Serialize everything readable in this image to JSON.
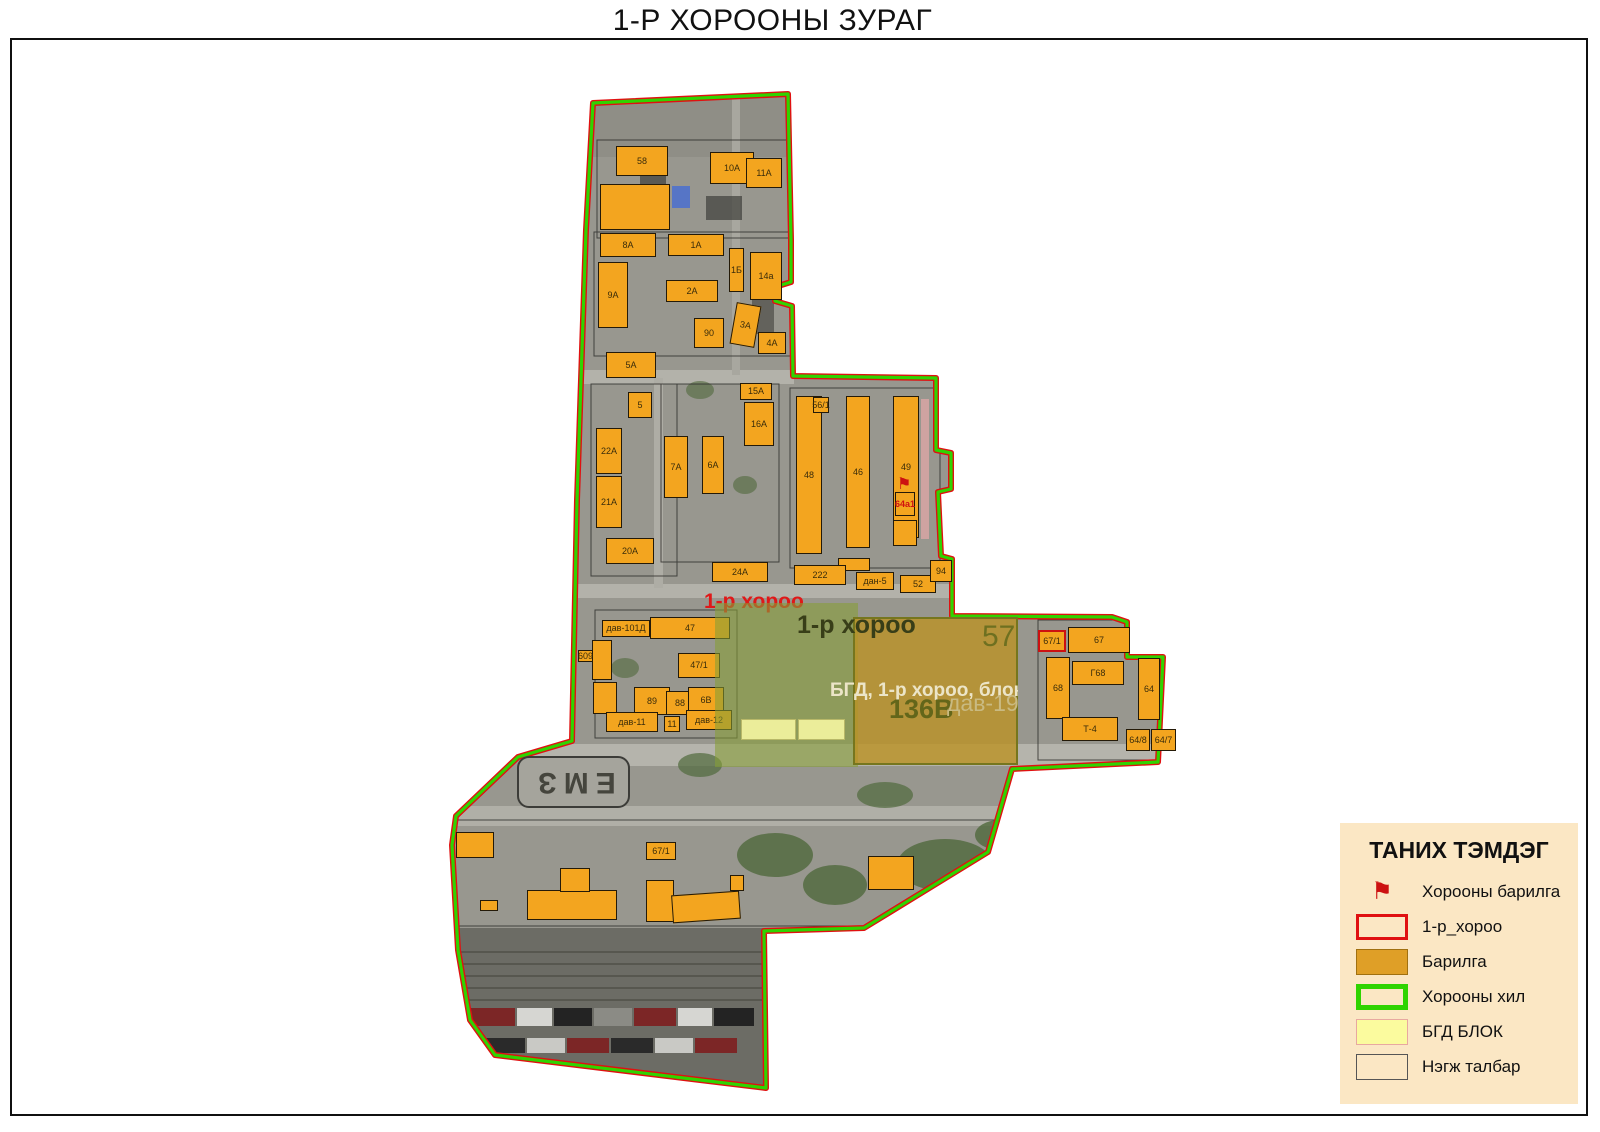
{
  "title": "1-Р ХОРООНЫ ЗУРАГ",
  "legend": {
    "title": "ТАНИХ ТЭМДЭГ",
    "items": [
      {
        "type": "flag",
        "label": "Хорооны барилга"
      },
      {
        "type": "red-outline",
        "label": "1-р_хороо"
      },
      {
        "type": "orange-fill",
        "label": "Барилга"
      },
      {
        "type": "green-outline",
        "label": "Хорооны хил"
      },
      {
        "type": "yellow-fill",
        "label": "БГД БЛОК"
      },
      {
        "type": "beige-fill",
        "label": "Нэгж талбар"
      }
    ]
  },
  "map": {
    "red_area_label": "1-р хороо",
    "overlay_area_label": "1-р хороо",
    "parcel_number": "57",
    "block_caption": "БГД, 1-р хороо, блок",
    "parcel_code": "136В",
    "dav_label": "дав-19",
    "ground_marking": "ЕМЗ",
    "buildings": [
      {
        "label": "58",
        "x": 616,
        "y": 146,
        "w": 52,
        "h": 30
      },
      {
        "label": "",
        "x": 600,
        "y": 184,
        "w": 70,
        "h": 46
      },
      {
        "label": "10A",
        "x": 710,
        "y": 152,
        "w": 44,
        "h": 32
      },
      {
        "label": "11A",
        "x": 746,
        "y": 158,
        "w": 36,
        "h": 30
      },
      {
        "label": "8A",
        "x": 600,
        "y": 233,
        "w": 56,
        "h": 24
      },
      {
        "label": "1A",
        "x": 668,
        "y": 234,
        "w": 56,
        "h": 22
      },
      {
        "label": "1Б",
        "x": 729,
        "y": 248,
        "w": 15,
        "h": 44
      },
      {
        "label": "14a",
        "x": 750,
        "y": 252,
        "w": 32,
        "h": 48
      },
      {
        "label": "9A",
        "x": 598,
        "y": 262,
        "w": 30,
        "h": 66
      },
      {
        "label": "2A",
        "x": 666,
        "y": 280,
        "w": 52,
        "h": 22
      },
      {
        "label": "90",
        "x": 694,
        "y": 318,
        "w": 30,
        "h": 30
      },
      {
        "label": "3A",
        "x": 733,
        "y": 304,
        "w": 25,
        "h": 42,
        "rot": 10
      },
      {
        "label": "4A",
        "x": 758,
        "y": 332,
        "w": 28,
        "h": 22
      },
      {
        "label": "5A",
        "x": 606,
        "y": 352,
        "w": 50,
        "h": 26
      },
      {
        "label": "5",
        "x": 628,
        "y": 392,
        "w": 24,
        "h": 26
      },
      {
        "label": "15A",
        "x": 740,
        "y": 383,
        "w": 32,
        "h": 17
      },
      {
        "label": "16A",
        "x": 744,
        "y": 402,
        "w": 30,
        "h": 44
      },
      {
        "label": "22A",
        "x": 596,
        "y": 428,
        "w": 26,
        "h": 46
      },
      {
        "label": "7A",
        "x": 664,
        "y": 436,
        "w": 24,
        "h": 62
      },
      {
        "label": "6A",
        "x": 702,
        "y": 436,
        "w": 22,
        "h": 58
      },
      {
        "label": "21A",
        "x": 596,
        "y": 476,
        "w": 26,
        "h": 52
      },
      {
        "label": "20A",
        "x": 606,
        "y": 538,
        "w": 48,
        "h": 26
      },
      {
        "label": "48",
        "x": 796,
        "y": 396,
        "w": 26,
        "h": 158
      },
      {
        "label": "46",
        "x": 846,
        "y": 396,
        "w": 24,
        "h": 152
      },
      {
        "label": "49",
        "x": 893,
        "y": 396,
        "w": 26,
        "h": 142
      },
      {
        "label": "56/1",
        "x": 813,
        "y": 397,
        "w": 16,
        "h": 16
      },
      {
        "label": "64а1",
        "x": 895,
        "y": 492,
        "w": 20,
        "h": 24,
        "flag": true
      },
      {
        "label": "",
        "x": 893,
        "y": 520,
        "w": 24,
        "h": 26
      },
      {
        "label": "",
        "x": 838,
        "y": 558,
        "w": 32,
        "h": 13
      },
      {
        "label": "24A",
        "x": 712,
        "y": 562,
        "w": 56,
        "h": 20
      },
      {
        "label": "222",
        "x": 794,
        "y": 565,
        "w": 52,
        "h": 20
      },
      {
        "label": "дан-5",
        "x": 856,
        "y": 572,
        "w": 38,
        "h": 18
      },
      {
        "label": "52",
        "x": 900,
        "y": 575,
        "w": 36,
        "h": 18
      },
      {
        "label": "94",
        "x": 930,
        "y": 560,
        "w": 22,
        "h": 22
      },
      {
        "label": "дав-101Д",
        "x": 602,
        "y": 620,
        "w": 48,
        "h": 17
      },
      {
        "label": "47",
        "x": 650,
        "y": 617,
        "w": 80,
        "h": 22
      },
      {
        "label": "",
        "x": 592,
        "y": 640,
        "w": 20,
        "h": 40
      },
      {
        "label": "609",
        "x": 578,
        "y": 650,
        "w": 15,
        "h": 12
      },
      {
        "label": "47/1",
        "x": 678,
        "y": 653,
        "w": 42,
        "h": 25
      },
      {
        "label": "",
        "x": 593,
        "y": 682,
        "w": 24,
        "h": 32
      },
      {
        "label": "89",
        "x": 634,
        "y": 687,
        "w": 36,
        "h": 28
      },
      {
        "label": "88",
        "x": 666,
        "y": 691,
        "w": 28,
        "h": 24
      },
      {
        "label": "6В",
        "x": 688,
        "y": 687,
        "w": 36,
        "h": 26
      },
      {
        "label": "дав-11",
        "x": 606,
        "y": 712,
        "w": 52,
        "h": 20
      },
      {
        "label": "11",
        "x": 664,
        "y": 716,
        "w": 16,
        "h": 16
      },
      {
        "label": "дав-12",
        "x": 686,
        "y": 710,
        "w": 46,
        "h": 20
      },
      {
        "label": "67/1",
        "x": 1038,
        "y": 630,
        "w": 28,
        "h": 22,
        "red": true
      },
      {
        "label": "67",
        "x": 1068,
        "y": 627,
        "w": 62,
        "h": 26
      },
      {
        "label": "Г68",
        "x": 1072,
        "y": 661,
        "w": 52,
        "h": 24
      },
      {
        "label": "68",
        "x": 1046,
        "y": 657,
        "w": 24,
        "h": 62
      },
      {
        "label": "64",
        "x": 1138,
        "y": 658,
        "w": 22,
        "h": 62
      },
      {
        "label": "Т-4",
        "x": 1062,
        "y": 717,
        "w": 56,
        "h": 24
      },
      {
        "label": "64/8",
        "x": 1126,
        "y": 729,
        "w": 24,
        "h": 22
      },
      {
        "label": "64/7",
        "x": 1151,
        "y": 729,
        "w": 25,
        "h": 22
      },
      {
        "label": "",
        "x": 456,
        "y": 832,
        "w": 38,
        "h": 26
      },
      {
        "label": "67/1",
        "x": 646,
        "y": 842,
        "w": 30,
        "h": 18
      },
      {
        "label": "",
        "x": 527,
        "y": 890,
        "w": 90,
        "h": 30
      },
      {
        "label": "",
        "x": 560,
        "y": 868,
        "w": 30,
        "h": 24
      },
      {
        "label": "",
        "x": 646,
        "y": 880,
        "w": 28,
        "h": 42
      },
      {
        "label": "",
        "x": 672,
        "y": 893,
        "w": 68,
        "h": 28,
        "rot": -4
      },
      {
        "label": "",
        "x": 868,
        "y": 856,
        "w": 46,
        "h": 34
      },
      {
        "label": "",
        "x": 730,
        "y": 875,
        "w": 14,
        "h": 16
      },
      {
        "label": "",
        "x": 480,
        "y": 900,
        "w": 18,
        "h": 11
      }
    ]
  },
  "colors": {
    "building_fill": "#f3a51f",
    "boundary_green": "#2fd400",
    "boundary_red": "#e01111",
    "legend_bg": "#fbe7c4",
    "bgd_block_fill": "#fbfb9e",
    "overlay_green": "#869e36",
    "overlay_amber": "#bc9224"
  }
}
